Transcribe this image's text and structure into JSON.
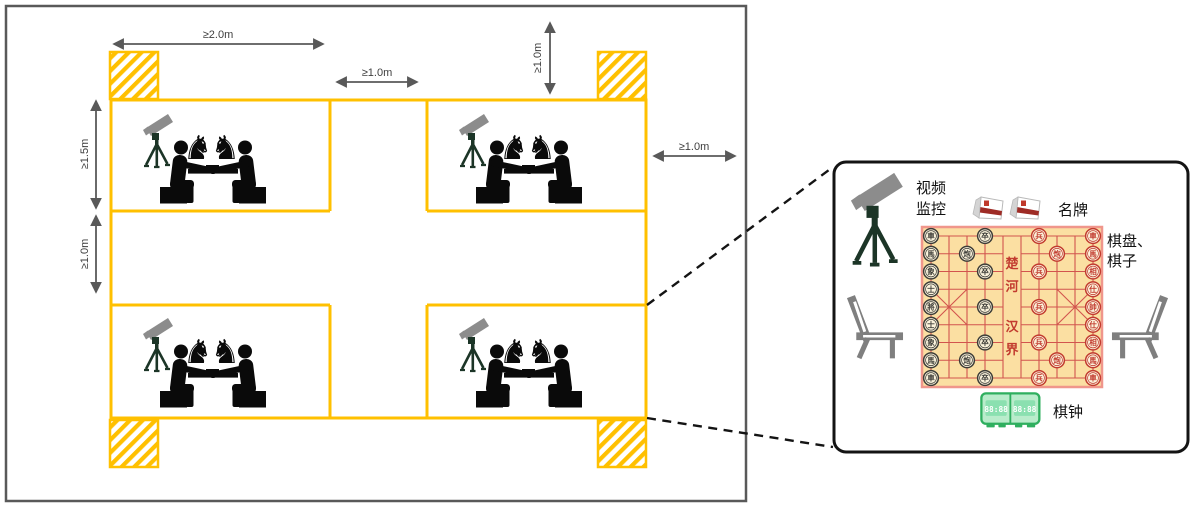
{
  "floorplan": {
    "dims": {
      "top_width": "≥2.0m",
      "center_aisle": "≥1.0m",
      "top_clearance": "≥1.0m",
      "right_clearance": "≥1.0m",
      "row_depth": "≥1.5m",
      "row_gap": "≥1.0m"
    }
  },
  "detail": {
    "camera_label": [
      "视频",
      "监控"
    ],
    "nameplate_label": "名牌",
    "board_label": [
      "棋盘、",
      "棋子"
    ],
    "clock_label": "棋钟",
    "clock_displays": [
      "88:88",
      "88:88"
    ],
    "board": {
      "river_top": "楚河",
      "river_bottom": "汉界",
      "black_back_file": [
        "車",
        "馬",
        "象",
        "士",
        "將",
        "士",
        "象",
        "馬",
        "車"
      ],
      "red_back_file": [
        "車",
        "馬",
        "相",
        "仕",
        "帥",
        "仕",
        "相",
        "馬",
        "車"
      ],
      "black_cannon": "炮",
      "red_cannon": "炮",
      "black_soldier": "卒",
      "red_soldier": "兵"
    }
  },
  "icons": {
    "knight_glyph": "♞",
    "camera": "cctv-camera-on-tripod",
    "players": "two-players-at-chess-table",
    "chair": "side-chair",
    "nameplate": "tent-name-card",
    "clock": "digital-chess-clock"
  },
  "colors": {
    "accent": "#FFC000",
    "dim_line": "#595959",
    "silhouette": "#0A0A0A",
    "camera_gray": "#8C8C8C",
    "tripod_green": "#1C3527",
    "chair_gray": "#7F7F7F",
    "clock_green": "#2FAF5F",
    "clock_body": "#B9ECCB",
    "clock_display": "#8BE0B0",
    "plate_stripe": "#9E2B25",
    "panel_border": "#141414",
    "board_bg": "#FBDFA2",
    "board_line": "#D2544E",
    "board_border": "#F0968B",
    "piece_red": "#C23B2F",
    "piece_black": "#3D3D38",
    "piece_bg": "#FBF3DC"
  }
}
